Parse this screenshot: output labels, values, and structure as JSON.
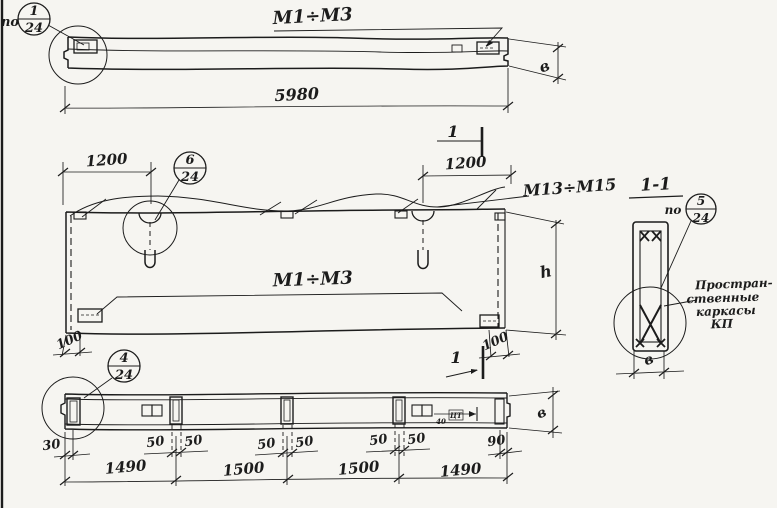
{
  "palette": {
    "ink": "#1c1c1c",
    "paper": "#f6f5f1"
  },
  "top_view": {
    "po_label": "по",
    "balloon": {
      "num": "1",
      "den": "24"
    },
    "marks_label": "М1÷М3",
    "length_dim": "5980",
    "width_dim": "в",
    "cut_label": "1"
  },
  "middle_view": {
    "balloon": {
      "num": "6",
      "den": "24"
    },
    "left_loop_dim": "1200",
    "right_loop_dim": "1200",
    "marks_label": "М1÷М3",
    "marks_label_right": "М13÷М15",
    "corner_dim_left": "100",
    "corner_dim_right": "100",
    "height_dim": "h",
    "cut_label": "1"
  },
  "section_view": {
    "title": "1-1",
    "po_label": "по",
    "balloon": {
      "num": "5",
      "den": "24"
    },
    "note_line1": "Простран-",
    "note_line2": "ственные",
    "note_line3": "каркасы",
    "note_line4": "КП",
    "width_dim": "в"
  },
  "bottom_view": {
    "balloon": {
      "num": "4",
      "den": "24"
    },
    "width_dim": "в",
    "edge_dim_left": "30",
    "edge_dim_right": "90",
    "pair1_left": "50",
    "pair1_right": "50",
    "pair2_left": "50",
    "pair2_right": "50",
    "pair3_left": "50",
    "pair3_right": "50",
    "embed_dim": "40",
    "embed_mark": "ЦТ",
    "span1": "1490",
    "span2": "1500",
    "span3": "1500",
    "span4": "1490"
  }
}
